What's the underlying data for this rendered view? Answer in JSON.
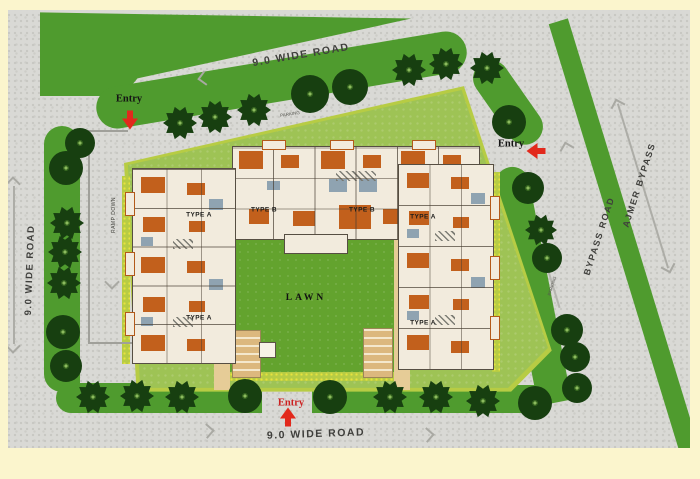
{
  "plan": {
    "roads": [
      {
        "id": "top",
        "text": "9.0 WIDE ROAD"
      },
      {
        "id": "left",
        "text": "9.0 WIDE ROAD"
      },
      {
        "id": "bottom",
        "text": "9.0 WIDE ROAD"
      },
      {
        "id": "bypass",
        "text": "BYPASS ROAD"
      },
      {
        "id": "ajmer",
        "text": "AJMER BYPASS"
      }
    ],
    "areas": {
      "lawn": "LAWN",
      "ramp": "RAMP DOWN",
      "parking_top": "PARKING",
      "parking_right": "PARKING"
    },
    "units": [
      {
        "text": "TYPE A"
      },
      {
        "text": "TYPE B"
      },
      {
        "text": "TYPE B"
      },
      {
        "text": "TYPE A"
      },
      {
        "text": "TYPE A"
      },
      {
        "text": "TYPE A"
      }
    ],
    "entries": [
      {
        "text": "Entry",
        "position": "top-left",
        "arrow": "down"
      },
      {
        "text": "Entry",
        "position": "right",
        "arrow": "left"
      },
      {
        "text": "Entry",
        "position": "bottom",
        "arrow": "up"
      }
    ],
    "colors": {
      "frame": "#fbf5cd",
      "road": "#d9d9d5",
      "verge_green": "#4f9b2e",
      "site_green": "#9ec355",
      "lawn_green": "#63a32e",
      "hedge": "#b7cc44",
      "tree": "#173f10",
      "building": "#f2ebdd",
      "furniture": "#c2601c",
      "walkway": "#e6cc97",
      "entry_arrow": "#e2291c"
    },
    "trees": [
      {
        "x": 180,
        "y": 123,
        "r": 17,
        "s": "p"
      },
      {
        "x": 215,
        "y": 117,
        "r": 17,
        "s": "p"
      },
      {
        "x": 254,
        "y": 110,
        "r": 17,
        "s": "p"
      },
      {
        "x": 310,
        "y": 94,
        "r": 19,
        "s": "c"
      },
      {
        "x": 350,
        "y": 87,
        "r": 18,
        "s": "c"
      },
      {
        "x": 409,
        "y": 70,
        "r": 17,
        "s": "p"
      },
      {
        "x": 446,
        "y": 64,
        "r": 17,
        "s": "p"
      },
      {
        "x": 487,
        "y": 68,
        "r": 17,
        "s": "p"
      },
      {
        "x": 509,
        "y": 122,
        "r": 17,
        "s": "c"
      },
      {
        "x": 528,
        "y": 188,
        "r": 16,
        "s": "c"
      },
      {
        "x": 541,
        "y": 230,
        "r": 16,
        "s": "p"
      },
      {
        "x": 547,
        "y": 258,
        "r": 15,
        "s": "c"
      },
      {
        "x": 567,
        "y": 330,
        "r": 16,
        "s": "c"
      },
      {
        "x": 575,
        "y": 357,
        "r": 15,
        "s": "c"
      },
      {
        "x": 577,
        "y": 388,
        "r": 15,
        "s": "c"
      },
      {
        "x": 93,
        "y": 397,
        "r": 17,
        "s": "p"
      },
      {
        "x": 137,
        "y": 396,
        "r": 17,
        "s": "p"
      },
      {
        "x": 182,
        "y": 397,
        "r": 17,
        "s": "p"
      },
      {
        "x": 245,
        "y": 396,
        "r": 17,
        "s": "c"
      },
      {
        "x": 330,
        "y": 397,
        "r": 17,
        "s": "c"
      },
      {
        "x": 390,
        "y": 397,
        "r": 17,
        "s": "p"
      },
      {
        "x": 436,
        "y": 397,
        "r": 17,
        "s": "p"
      },
      {
        "x": 483,
        "y": 401,
        "r": 17,
        "s": "p"
      },
      {
        "x": 535,
        "y": 403,
        "r": 17,
        "s": "c"
      },
      {
        "x": 80,
        "y": 143,
        "r": 15,
        "s": "c"
      },
      {
        "x": 66,
        "y": 168,
        "r": 17,
        "s": "c"
      },
      {
        "x": 67,
        "y": 223,
        "r": 17,
        "s": "p"
      },
      {
        "x": 65,
        "y": 252,
        "r": 17,
        "s": "p"
      },
      {
        "x": 64,
        "y": 283,
        "r": 17,
        "s": "p"
      },
      {
        "x": 63,
        "y": 332,
        "r": 17,
        "s": "c"
      },
      {
        "x": 66,
        "y": 366,
        "r": 16,
        "s": "c"
      }
    ],
    "chevrons": [
      {
        "x": 205,
        "y": 78,
        "a": -144
      },
      {
        "x": 207,
        "y": 431,
        "a": 41
      },
      {
        "x": 427,
        "y": 435,
        "a": 41
      },
      {
        "x": 567,
        "y": 149,
        "a": -60
      },
      {
        "x": 112,
        "y": 282,
        "a": 135
      },
      {
        "x": 13,
        "y": 184,
        "a": -45
      },
      {
        "x": 13,
        "y": 346,
        "a": 135
      },
      {
        "x": 618,
        "y": 106,
        "a": -62
      },
      {
        "x": 668,
        "y": 266,
        "a": 118
      }
    ]
  }
}
